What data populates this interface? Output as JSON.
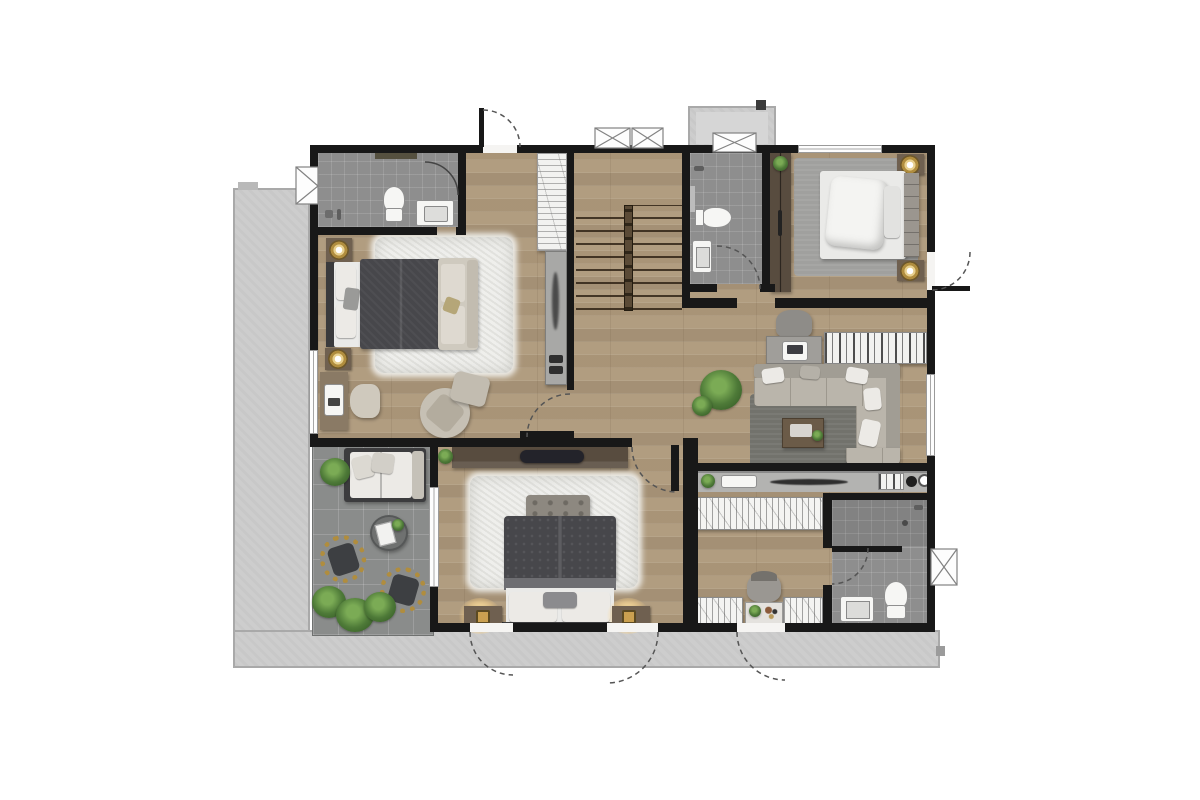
{
  "plan": {
    "kind": "residential-floor-plan-3d-render",
    "view": "top-down",
    "visible_text": [],
    "rooms": [
      {
        "name": "bathroom-upper-left",
        "floor": "tile",
        "items": [
          "toilet",
          "vanity-sink",
          "shower-glass-door",
          "shelf"
        ]
      },
      {
        "name": "bedroom-upper-left",
        "floor": "wood",
        "items": [
          "double-bed",
          "shag-rug",
          "loveseat",
          "nightstand",
          "gold-table-lamp",
          "desk",
          "laptop",
          "desk-chair",
          "swivel-armchair",
          "ottoman"
        ]
      },
      {
        "name": "entry-vestibule",
        "floor": "wood",
        "items": [
          "entry-door-swing",
          "linen-shelf",
          "console-table"
        ]
      },
      {
        "name": "staircase",
        "floor": "wood",
        "items": [
          "stair-treads",
          "center-railing"
        ]
      },
      {
        "name": "bathroom-upper-middle",
        "floor": "tile",
        "items": [
          "toilet",
          "sink",
          "shower-set",
          "door-swing"
        ]
      },
      {
        "name": "wardrobe-cabinet-strip",
        "floor": "wood",
        "items": [
          "built-in-wardrobe",
          "potted-plant"
        ]
      },
      {
        "name": "bedroom-upper-right",
        "floor": "wood",
        "items": [
          "double-bed-white",
          "area-rug",
          "nightstand",
          "gold-table-lamp",
          "window",
          "exterior-door-swing"
        ]
      },
      {
        "name": "family-area",
        "floor": "wood",
        "items": [
          "corner-sofa",
          "throw-pillows",
          "charcoal-rug",
          "coffee-table",
          "desk",
          "desk-chair",
          "laptop",
          "bookshelf",
          "potted-plant",
          "sideboard-counter",
          "counter-sink"
        ]
      },
      {
        "name": "master-bedroom",
        "floor": "wood",
        "items": [
          "king-bed",
          "tufted-bench",
          "shag-rug",
          "tv-dresser-console",
          "nightstand",
          "lamp-glow",
          "terrace-doors"
        ]
      },
      {
        "name": "walk-in-closet",
        "floor": "wood",
        "items": [
          "wardrobe-rack",
          "vanity-table",
          "vanity-stool",
          "potted-plant"
        ]
      },
      {
        "name": "bathroom-lower-right",
        "floor": "tile",
        "items": [
          "shower-area",
          "sink",
          "toilet",
          "window",
          "door-swing"
        ]
      },
      {
        "name": "terrace",
        "floor": "deck-tile",
        "items": [
          "outdoor-sofa",
          "round-coffee-table",
          "rattan-chair",
          "potted-plants",
          "glass-door"
        ]
      },
      {
        "name": "balcony-ledge-left",
        "floor": "concrete",
        "items": []
      },
      {
        "name": "balcony-ledge-bottom",
        "floor": "concrete",
        "items": []
      },
      {
        "name": "balcony-upper-right",
        "floor": "concrete",
        "items": [
          "window-x-symbol"
        ]
      }
    ],
    "symbols": [
      "door-swing-arc-dashed",
      "window-x-symbol",
      "black-wall",
      "white-window-strip"
    ]
  },
  "palette": {
    "wall": "#181818",
    "wood": "#b19d80",
    "tile": "#8e8e8e",
    "deck": "#8a8c8b",
    "concrete": "#cdcdcd",
    "concrete_edge": "#a9a9a9",
    "rug_white": "#efefec",
    "rug_gray": "#a0a09e",
    "rug_charcoal": "#72726c",
    "sofa": "#bab5ab",
    "sofa_dark": "#a19d94",
    "bed_dark": "#47474b",
    "bed_white": "#eaeae8",
    "furn_wood": "#6f6050",
    "furn_dark": "#584c3f",
    "counter": "#b3b3b1",
    "gold": "#b08d3e",
    "plant": "#4e7a38"
  }
}
